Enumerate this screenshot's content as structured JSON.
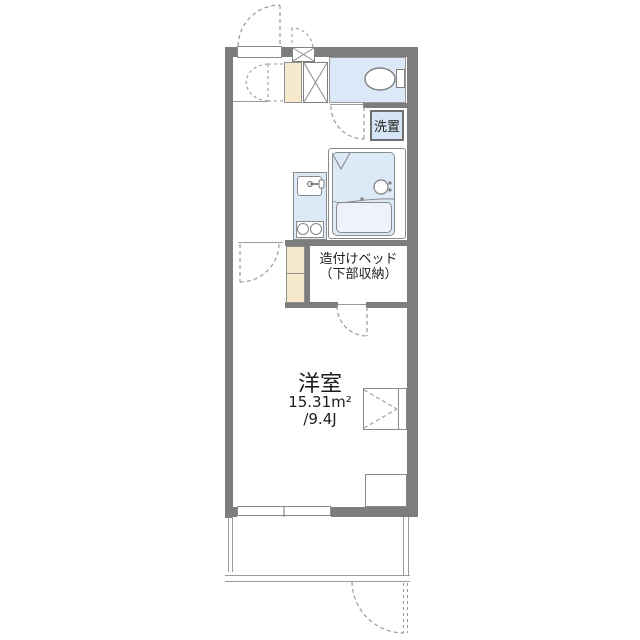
{
  "document": {
    "type": "japanese-apartment-floorplan",
    "style": "1K unit plan, top-down"
  },
  "labels": {
    "main_room": {
      "name": "洋室",
      "area_sqm": "15.31m²",
      "area_tatami": "/9.4J"
    },
    "built_in_bed": {
      "line1": "造付けベッド",
      "line2": "（下部収納）"
    },
    "laundry": {
      "label": "洗置"
    }
  },
  "colors": {
    "wall": "#7d7d7d",
    "water_area_fill": "#dce9f7",
    "toilet_room_fill": "#dbe8f7",
    "counter_fill": "#f7e9cc",
    "bathtub_fill": "#eef3fb",
    "fixture_line": "#8a8a8a",
    "dashed_door_line": "#9a9a9a",
    "text": "#1f1f1f"
  }
}
